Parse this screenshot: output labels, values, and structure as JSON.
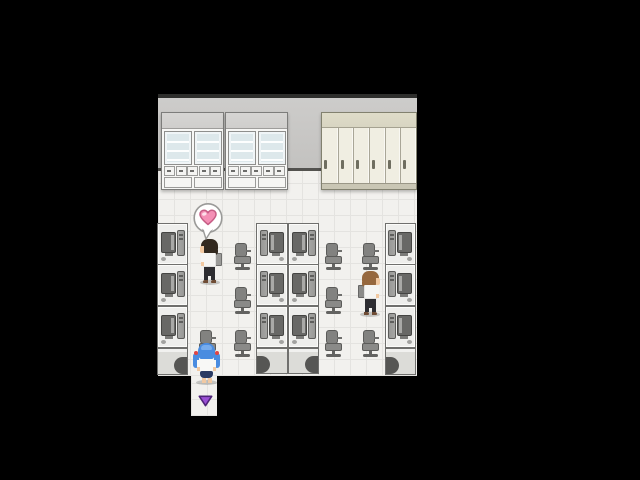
{
  "palette": {
    "background": "#000000",
    "wall_top_line": "#2e2e2c",
    "wall": "#cdcccA",
    "wall_shade": "#c3c2c0",
    "wall_base_line": "#53524f",
    "floor": "#f2f1ee",
    "floor_grid": "#e4e3e0",
    "cabinet_body": "#f7f7f5",
    "cabinet_band": "#cfcecc",
    "cabinet_border": "#7d7d7b",
    "glass": "#dde8eb",
    "locker_body": "#f0eee2",
    "locker_band": "#d8d5c2",
    "locker_border": "#82816f",
    "locker_divider": "#a9a697",
    "locker_handle": "#6f6e60",
    "desk": "#eeeeec",
    "desk_border": "#6f6f6d",
    "desk_front": "#dcdcd8",
    "desk_front_arch": "#565654",
    "monitor": "#686866",
    "monitor_screen": "#a9a9a7",
    "pc_tower": "#989896",
    "chair": "#8a8a88",
    "chair_dark": "#5b5b59",
    "shadow": "rgba(80,80,80,0.28)"
  },
  "map": {
    "bounds": {
      "x": 158,
      "y": 94,
      "width": 259,
      "height": 322
    },
    "wall": {
      "x": 158,
      "y": 94,
      "width": 259,
      "height": 77
    },
    "floor": {
      "x": 158,
      "y": 171,
      "width": 259,
      "height": 205,
      "tile_size": 16
    },
    "corridor": {
      "x": 191,
      "y": 376,
      "width": 26,
      "height": 40
    }
  },
  "furniture": {
    "glass_cabinets": [
      {
        "x": 161,
        "y": 112,
        "width": 63,
        "height": 78
      },
      {
        "x": 225,
        "y": 112,
        "width": 63,
        "height": 78
      }
    ],
    "lockers": {
      "x": 321,
      "y": 112,
      "width": 96,
      "height": 78,
      "door_count": 6
    },
    "desk_columns": [
      {
        "id": "left",
        "x": 157,
        "width": 31,
        "desk_ys": [
          223,
          264,
          306
        ],
        "desk_h": 42,
        "facing": "right",
        "front": {
          "y": 348,
          "height": 27,
          "arch": "right"
        }
      },
      {
        "id": "mid-left",
        "x": 256,
        "width": 32,
        "desk_ys": [
          223,
          264,
          306
        ],
        "desk_h": 42,
        "facing": "left",
        "front": {
          "y": 348,
          "height": 26,
          "arch": "left"
        }
      },
      {
        "id": "mid-right",
        "x": 288,
        "width": 31,
        "desk_ys": [
          223,
          264,
          306
        ],
        "desk_h": 42,
        "facing": "right",
        "front": {
          "y": 348,
          "height": 26,
          "arch": "right"
        }
      },
      {
        "id": "right",
        "x": 385,
        "width": 31,
        "desk_ys": [
          223,
          264,
          306
        ],
        "desk_h": 42,
        "facing": "left",
        "front": {
          "y": 348,
          "height": 27,
          "arch": "left"
        }
      }
    ],
    "chairs": [
      {
        "x": 234,
        "y": 243
      },
      {
        "x": 234,
        "y": 287
      },
      {
        "x": 234,
        "y": 330
      },
      {
        "x": 325,
        "y": 243
      },
      {
        "x": 325,
        "y": 287
      },
      {
        "x": 325,
        "y": 330
      },
      {
        "x": 362,
        "y": 243
      },
      {
        "x": 362,
        "y": 330
      },
      {
        "x": 199,
        "y": 330
      }
    ]
  },
  "characters": [
    {
      "id": "npc-dark-hair",
      "x": 198,
      "y": 239,
      "facing": "left",
      "hair": "#32291f",
      "shirt": "#f5f5f3",
      "pants": "#2d2d31",
      "shoes": "#6f4c34",
      "bag": "#9b9b99",
      "skin": "#f1c9a2"
    },
    {
      "id": "npc-brown-hair",
      "x": 358,
      "y": 271,
      "facing": "right",
      "hair": "#96683e",
      "shirt": "#f5f5f3",
      "pants": "#2d2d31",
      "shoes": "#6f4c34",
      "bag": "#8b8b89",
      "skin": "#f1c9a2"
    },
    {
      "id": "player-blue-hair",
      "x": 193,
      "y": 343,
      "facing": "up",
      "hair": "#4a8ce0",
      "hair_light": "#7fb2ee",
      "ribbon": "#e04444",
      "shirt": "#f8f8f6",
      "pants": "#2b3b63",
      "skin": "#f1c9a2"
    }
  ],
  "overlays": {
    "heart_bubble": {
      "x": 193,
      "y": 203,
      "width": 31,
      "height": 38,
      "bubble_color": "#ffffff",
      "border": "#9a9a98",
      "heart_color": "#f48fb5",
      "heart_light": "#fde0ea",
      "heart_outline": "#c65d85"
    },
    "exit_arrow": {
      "x": 198,
      "y": 395,
      "width": 15,
      "height": 12,
      "color": "#9a4fd4",
      "outline": "#4e2478"
    }
  }
}
